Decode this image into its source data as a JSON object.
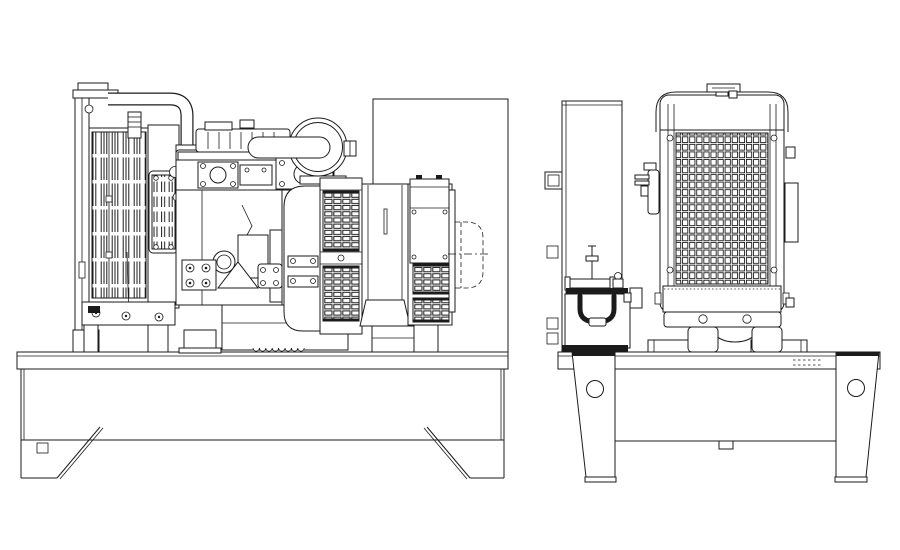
{
  "drawing": {
    "background_color": "#ffffff",
    "line_color": "#1b1b1b",
    "type": "technical-line-drawing",
    "views": [
      {
        "id": "side-elevation",
        "components": [
          "radiator",
          "radiator-filler-cap",
          "radiator-core-slats",
          "louver-panel",
          "coolant-hose",
          "engine",
          "rocker-cover",
          "exhaust-flange-plate",
          "air-cleaner",
          "intake-pipe",
          "oil-filter",
          "oil-pan",
          "mounting-gusset",
          "flywheel-housing",
          "alternator",
          "alternator-vent-grilles",
          "terminal-box",
          "outlet-duct-dashed",
          "backplate",
          "base-frame",
          "base-feet",
          "diagonal-braces"
        ]
      },
      {
        "id": "front-elevation",
        "components": [
          "support-panel",
          "battery",
          "battery-hold-down-strap",
          "battery-clamp-bar",
          "radiator-cap",
          "radiator-core-mesh",
          "radiator-side-channels",
          "radiator-feet",
          "mounting-brackets",
          "inlet-elbow",
          "base-rail",
          "base-legs",
          "lifting-holes"
        ]
      }
    ]
  }
}
